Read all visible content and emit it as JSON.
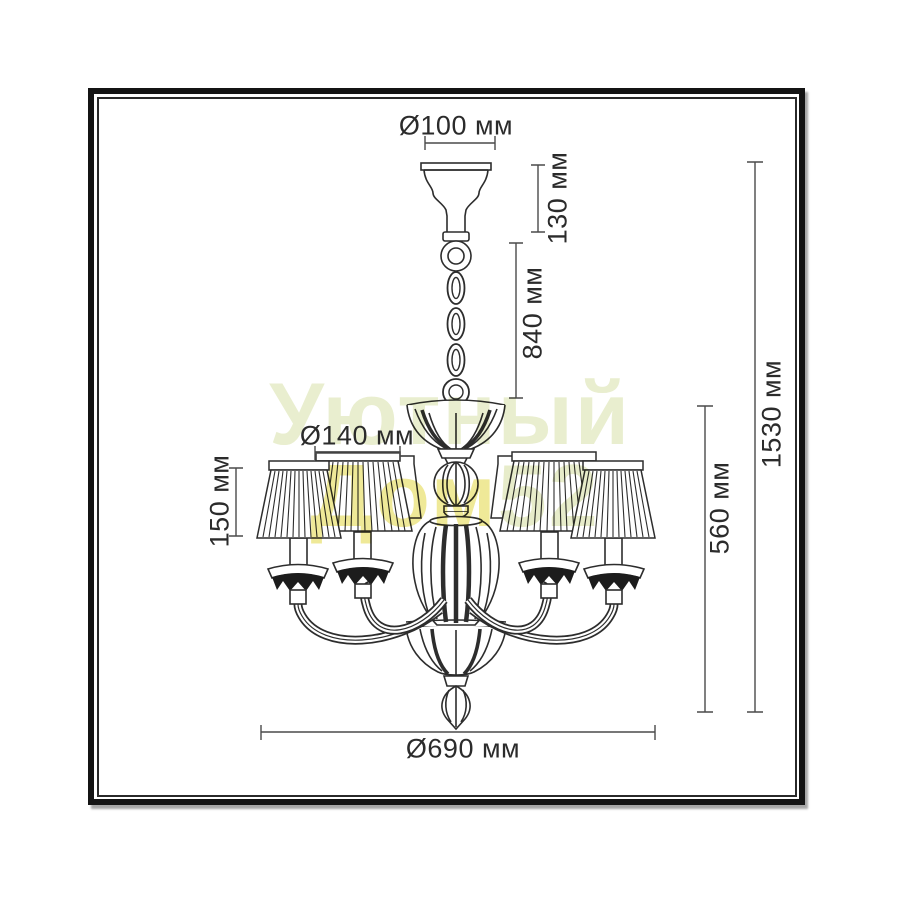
{
  "drawing": {
    "subject": "chandelier technical dimension drawing",
    "line_color": "#2d2d2d",
    "dimension_line_color": "#4a4a4a"
  },
  "watermark": {
    "line1": "Уютный",
    "line2_part1": "Дом",
    "line2_part2": "52",
    "color_pale": "#e9eecf",
    "color_yellow": "#efe998"
  },
  "dimensions": {
    "canopy_diameter": {
      "label": "Ø100 мм"
    },
    "canopy_height": {
      "label": "130 мм"
    },
    "chain_length": {
      "label": "840 мм"
    },
    "total_height": {
      "label": "1530 мм"
    },
    "body_height": {
      "label": "560 мм"
    },
    "shade_diameter": {
      "label": "Ø140 мм"
    },
    "shade_height": {
      "label": "150 мм"
    },
    "fixture_diameter": {
      "label": "Ø690 мм"
    }
  }
}
